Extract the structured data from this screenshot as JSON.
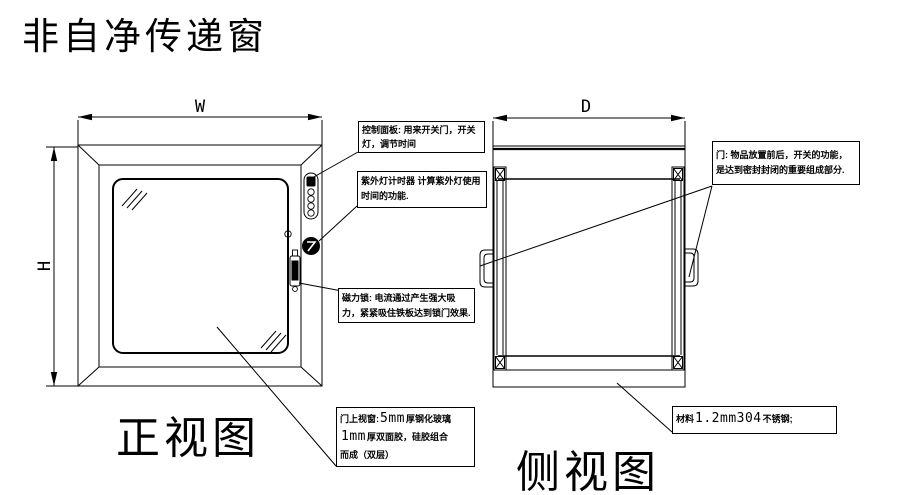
{
  "title": "非自净传递窗",
  "front_view": {
    "label": "正视图",
    "dim_width": "W",
    "dim_height": "H"
  },
  "side_view": {
    "label": "侧视图",
    "dim_depth": "D"
  },
  "callouts": {
    "control_panel": "控制面板: 用来开关门，开关灯，调节时间",
    "uv_timer": "紫外灯计时器 计算紫外灯使用时间的功能.",
    "magnetic_lock": "磁力锁: 电流通过产生强大吸力，紧紧吸住铁板达到锁门效果.",
    "door_window": {
      "label": "门上视窗:",
      "glass_thickness": "5mm",
      "glass_text": "厚钢化玻璃",
      "tape_thickness": "1mm",
      "tape_text": "厚双面胶，硅胶组合",
      "tail_text": "而成（双层）"
    },
    "door": "门: 物品放置前后，开关的功能，是达到密封封闭的重要组成部分.",
    "material": {
      "prefix": "材料",
      "spec": "1.2mm304",
      "suffix": "不锈钢;"
    }
  },
  "colors": {
    "line": "#000000",
    "background": "#ffffff"
  }
}
